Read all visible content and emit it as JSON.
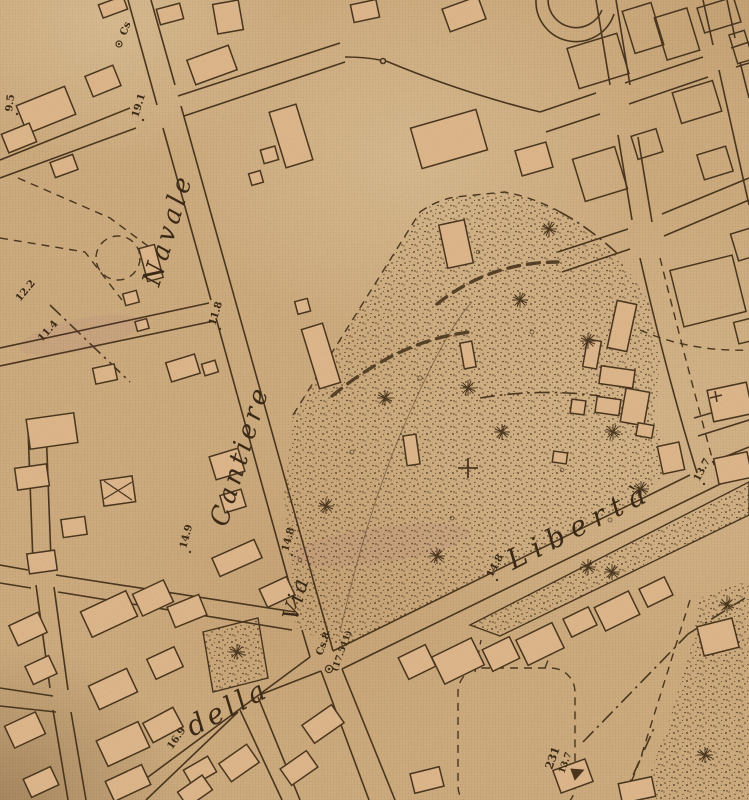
{
  "map": {
    "labels": {
      "navale": "Navale",
      "cantiere": "Cantiere",
      "via": "Via",
      "della": "della",
      "liberta": "Libertà"
    },
    "heights": {
      "h9_5": "9.5",
      "h19_1": "19.1",
      "h12_2": "12.2",
      "h11_4": "11.4",
      "h11_8": "11.8",
      "h14_9": "14.9",
      "h14_8_a": "14.8",
      "h14_8_b": "14.8",
      "h16_9": "16.9",
      "h13_7_a": "13.7",
      "h13_7_b": "13.7",
      "h231": "231"
    },
    "benchmarks": {
      "cs_top": "Cs",
      "cs8": "Cs.8",
      "cs8_value": "(17.511)"
    },
    "colors": {
      "paper": "#d0ae81",
      "line": "#46321b",
      "building_fill": "#dfb78c",
      "stipple": "#46321b",
      "label_ink": "#352512"
    }
  }
}
